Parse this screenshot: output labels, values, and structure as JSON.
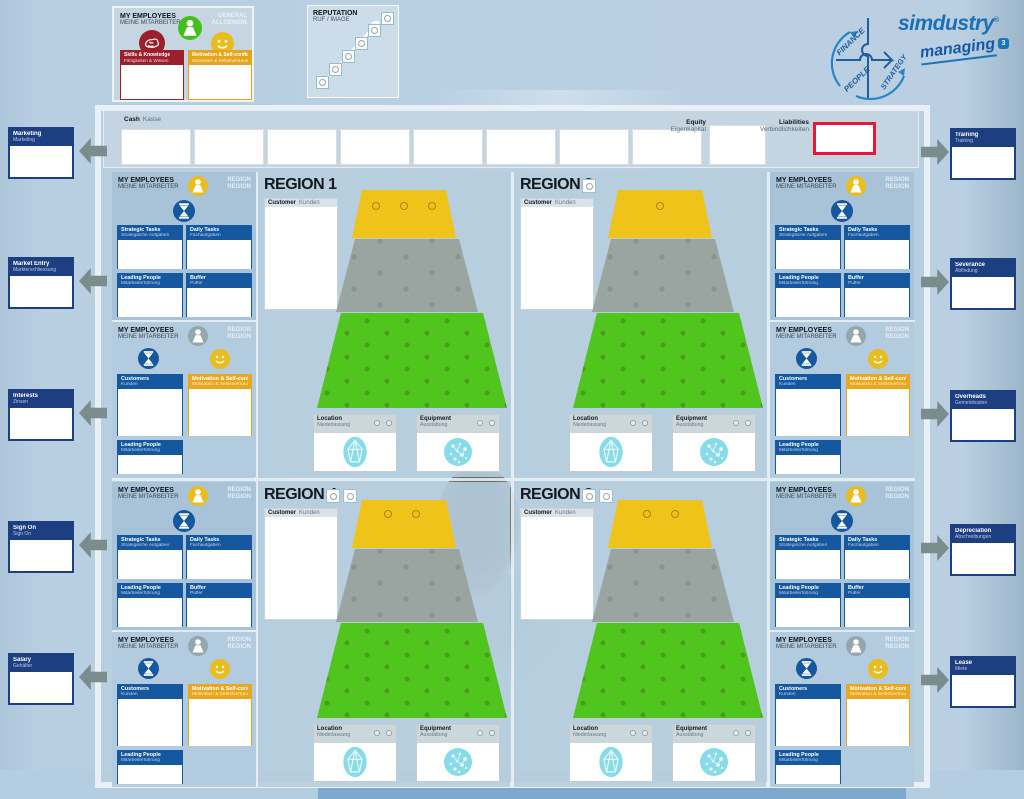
{
  "logo": {
    "brand": "simdustry",
    "registered": "®",
    "product": "managing",
    "product_sup": "3",
    "puzzle_words": {
      "finance": "FINANCE",
      "people": "PEOPLE",
      "strategy": "STRATEGY"
    },
    "brand_color": "#1a70b6"
  },
  "general_panel": {
    "title_en": "MY EMPLOYEES",
    "title_de": "MEINE MITARBEITER",
    "corner_en": "GENERAL",
    "corner_de": "ALLGEMEIN",
    "skills_en": "Skills & Knowledge",
    "skills_de": "Fähigkeiten & Wissen",
    "motivation_en": "Motivation & Self-confidence",
    "motivation_de": "Motivation & Selbstvertrauen",
    "skills_color": "#9c1f2e",
    "motivation_color": "#e2a51c"
  },
  "reputation_panel": {
    "title_en": "REPUTATION",
    "title_de": "RUF / IMAGE",
    "steps": 6
  },
  "finance_bar": {
    "cash": {
      "label_en": "Cash",
      "label_de": "Kasse",
      "slots": 8
    },
    "equity": {
      "label_en": "Equity",
      "label_de": "Eigenkapital"
    },
    "liabilities": {
      "label_en": "Liabilities",
      "label_de": "Verbindlichkeiten",
      "border_color": "#e5183c"
    }
  },
  "left_labels": [
    {
      "en": "Marketing",
      "de": "Marketing"
    },
    {
      "en": "Market Entry",
      "de": "Markterschliessung"
    },
    {
      "en": "Interests",
      "de": "Zinsen"
    },
    {
      "en": "Sign On",
      "de": "Sign On"
    },
    {
      "en": "Salary",
      "de": "Gehälter"
    }
  ],
  "right_labels": [
    {
      "en": "Training",
      "de": "Training"
    },
    {
      "en": "Severance",
      "de": "Abfindung"
    },
    {
      "en": "Overheads",
      "de": "Gemeinkosten"
    },
    {
      "en": "Depreciation",
      "de": "Abschreibungen"
    },
    {
      "en": "Lease",
      "de": "Miete"
    }
  ],
  "regions": [
    {
      "title": "REGION 1",
      "markers": 0,
      "pins": [
        [
          118,
          34
        ],
        [
          146,
          34
        ],
        [
          174,
          34
        ]
      ]
    },
    {
      "title": "REGION 2",
      "markers": 1,
      "pins": [
        [
          146,
          34
        ]
      ]
    },
    {
      "title": "REGION 4",
      "markers": 2,
      "pins": [
        [
          130,
          32
        ],
        [
          158,
          32
        ]
      ]
    },
    {
      "title": "REGION 3",
      "markers": 2,
      "pins": [
        [
          133,
          32
        ],
        [
          161,
          32
        ]
      ]
    }
  ],
  "region_common": {
    "customer_en": "Customer",
    "customer_de": "Kunden",
    "location_en": "Location",
    "location_de": "Niederlassung",
    "equipment_en": "Equipment",
    "equipment_de": "Ausstattung",
    "level_colors": {
      "top": "#efc31a",
      "middle": "#9aa5a2",
      "bottom": "#4fc51e"
    }
  },
  "employee_task_panel": {
    "title_en": "MY EMPLOYEES",
    "title_de": "MEINE MITARBEITER",
    "corner_en": "REGION",
    "corner_de": "REGION",
    "boxes": [
      {
        "en": "Strategic Tasks",
        "de": "Strategische Aufgaben"
      },
      {
        "en": "Daily Tasks",
        "de": "Fachaufgaben"
      },
      {
        "en": "Leading People",
        "de": "Mitarbeiterführung"
      },
      {
        "en": "Buffer",
        "de": "Puffer"
      }
    ]
  },
  "employee_motivation_panel": {
    "title_en": "MY EMPLOYEES",
    "title_de": "MEINE MITARBEITER",
    "corner_en": "REGION",
    "corner_de": "REGION",
    "customers_en": "Customers",
    "customers_de": "Kunden",
    "motivation_en": "Motivation & Self-confidence",
    "motivation_de": "Motivation & Selbstvertrauen",
    "leading_en": "Leading People",
    "leading_de": "Mitarbeiterführung"
  }
}
